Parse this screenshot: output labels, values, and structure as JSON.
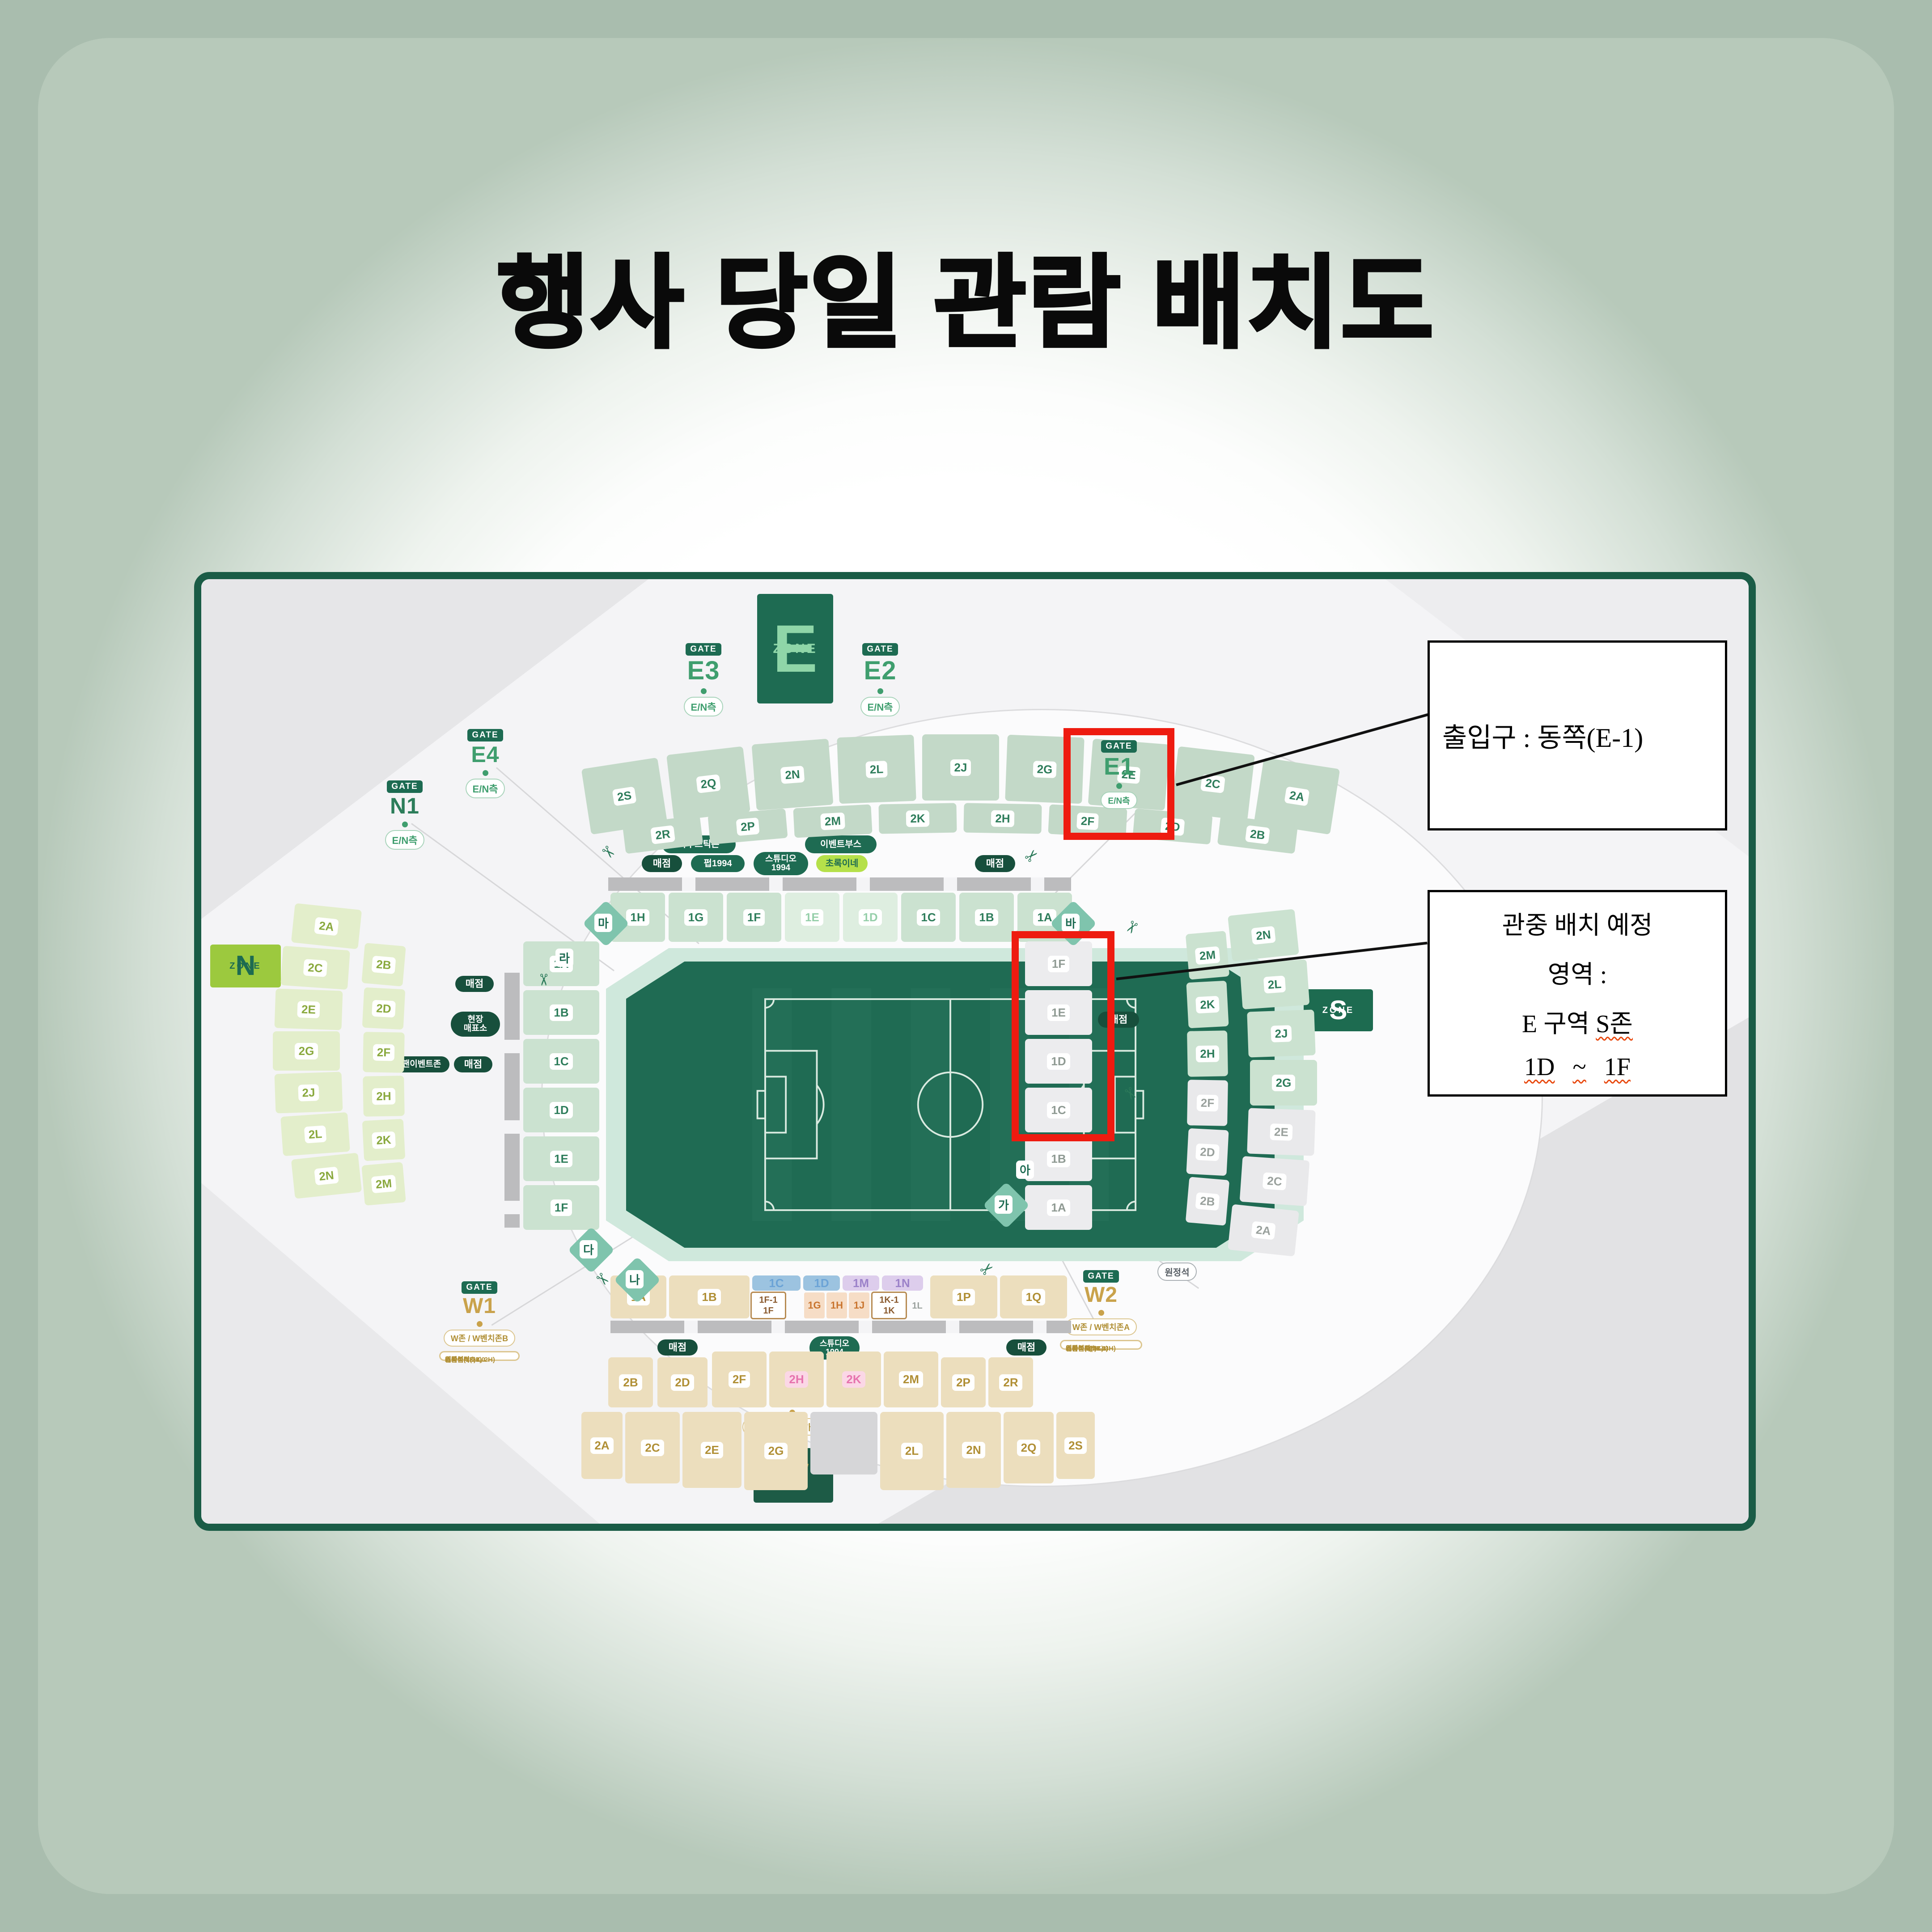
{
  "title": "행사 당일 관람 배치도",
  "annotations": {
    "entrance_note": "출입구 : 동쪽(E-1)",
    "placement_note": {
      "line1": "관중 배치 예정",
      "line2": "영역 :",
      "line3_prefix": "E 구역 ",
      "line3_zone": "S존",
      "line4_from": "1D",
      "line4_tilde": "~",
      "line4_to": "1F"
    }
  },
  "map": {
    "gate_word": "GATE",
    "zones": {
      "e": {
        "letter": "E",
        "word": "ZONE"
      },
      "n": {
        "letter": "N",
        "word": "ZONE"
      },
      "s": {
        "letter": "S",
        "word": "ZONE"
      },
      "w": {
        "letter": "W",
        "word": "ZONE"
      }
    },
    "gates": {
      "e1": {
        "code": "E1",
        "pill": "E/N측"
      },
      "e2": {
        "code": "E2",
        "pill": "E/N측"
      },
      "e3": {
        "code": "E3",
        "pill": "E/N측"
      },
      "e4": {
        "code": "E4",
        "pill": "E/N측"
      },
      "n1": {
        "code": "N1",
        "pill": "E/N측"
      },
      "s1": {
        "code": "S1",
        "pill": "원정석"
      },
      "w1": {
        "code": "W1",
        "pill": "W존 / W벤치존B",
        "info": [
          "스카이박스2.0",
          "테이블석(2K, 2H)",
          "원탁석(1F)",
          "커플석(1F-1)"
        ]
      },
      "w2": {
        "code": "W2",
        "pill": "W존 / W벤치존A",
        "info": [
          "스카이박스2.0",
          "테이블석(3K, 3H)",
          "원탁석(1L)",
          "스튜디오(1K)",
          "커플석A(1K-1)"
        ]
      },
      "vip": {
        "code": "VIP",
        "pill": "레드카펫존 / 스카이박스"
      }
    },
    "facilities": {
      "top_left_pill": "아쿠스틱존",
      "top_right_pill": "이벤트부스",
      "snack1": "매점",
      "pub": "펍1994",
      "studio_top": "스튜디오 1994",
      "chorok": "초록이네",
      "snack2": "매점",
      "left_snack1": "매점",
      "left_ticket_line1": "현장",
      "left_ticket_line2": "매표소",
      "fan_event": "팬이벤트존",
      "left_snack2": "매점",
      "right_snack": "매점",
      "bottom_snack1": "매점",
      "studio_bottom": "스튜디오 1994",
      "bottom_snack2": "매점"
    },
    "corner_labels": [
      "마",
      "바",
      "라",
      "다",
      "나",
      "가",
      "아"
    ],
    "decks": {
      "e_upper_row1": [
        "2S",
        "2Q",
        "2N",
        "2L",
        "2J",
        "2G",
        "2E",
        "2C",
        "2A"
      ],
      "e_upper_row2": [
        "2R",
        "2P",
        "2M",
        "2K",
        "2H",
        "2F",
        "2D",
        "2B"
      ],
      "e_lower": [
        "1H",
        "1G",
        "1F",
        "1E",
        "1D",
        "1C",
        "1B",
        "1A"
      ],
      "n_upper_col1": [
        "2A",
        "2C",
        "2E",
        "2G",
        "2J",
        "2L",
        "2N"
      ],
      "n_upper_col2": [
        "2B",
        "2D",
        "2F",
        "2H",
        "2K",
        "2M"
      ],
      "n_lower": [
        "1A",
        "1B",
        "1C",
        "1D",
        "1E",
        "1F"
      ],
      "s_upper_inner": [
        "2M",
        "2K",
        "2H",
        "2F",
        "2D",
        "2B"
      ],
      "s_upper_outer": [
        "2N",
        "2L",
        "2J",
        "2G",
        "2E",
        "2C",
        "2A"
      ],
      "s_lower": [
        "1F",
        "1E",
        "1D",
        "1C",
        "1B",
        "1A"
      ],
      "w_lower_left": [
        "1A",
        "1B"
      ],
      "w_lower_headers": [
        "1C",
        "1D",
        "1M",
        "1N"
      ],
      "w_lower_box1": [
        "1F-1",
        "1F"
      ],
      "w_lower_orange": [
        "1G",
        "1H",
        "1J"
      ],
      "w_lower_box2": [
        "1K-1",
        "1K"
      ],
      "w_lower_small": [
        "1L"
      ],
      "w_lower_right": [
        "1P",
        "1Q"
      ],
      "w_upper_row1": [
        "2B",
        "2D",
        "2F",
        "2H",
        "2K",
        "2M",
        "2P",
        "2R"
      ],
      "w_upper_row2": [
        "2A",
        "2C",
        "2E",
        "2G",
        "2L",
        "2N",
        "2Q",
        "2S"
      ]
    },
    "highlighted_lower_sections": [
      "1E",
      "1D"
    ],
    "red_boxed_sections": [
      "1F",
      "1E",
      "1D"
    ],
    "colors": {
      "highlight_red": "#ee1b10",
      "dark_green": "#1d6b52",
      "gold": "#c9a24b",
      "lime": "#9cc93e"
    }
  }
}
